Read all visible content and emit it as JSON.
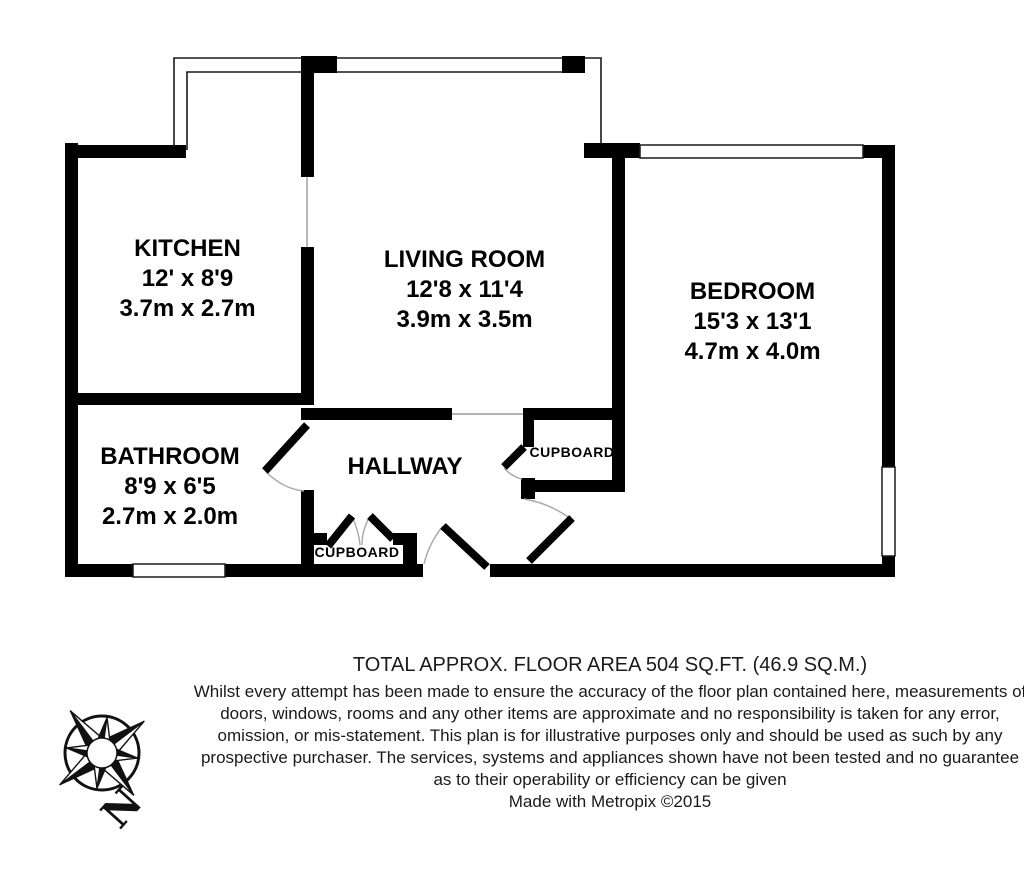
{
  "plan": {
    "rooms": {
      "kitchen": {
        "name": "KITCHEN",
        "imperial": "12' x 8'9",
        "metric": "3.7m x 2.7m"
      },
      "living_room": {
        "name": "LIVING ROOM",
        "imperial": "12'8 x 11'4",
        "metric": "3.9m x 3.5m"
      },
      "bedroom": {
        "name": "BEDROOM",
        "imperial": "15'3 x 13'1",
        "metric": "4.7m x 4.0m"
      },
      "bathroom": {
        "name": "BATHROOM",
        "imperial": "8'9 x 6'5",
        "metric": "2.7m x 2.0m"
      },
      "hallway": {
        "name": "HALLWAY"
      },
      "cupboard_hall": {
        "name": "CUPBOARD"
      },
      "cupboard_entry": {
        "name": "CUPBOARD"
      }
    },
    "colors": {
      "wall": "#000000",
      "background": "#ffffff",
      "door_arc": "#a8a8a8"
    }
  },
  "footer": {
    "area_line": "TOTAL APPROX. FLOOR AREA 504 SQ.FT. (46.9 SQ.M.)",
    "disclaimer": "Whilst every attempt has been made to ensure the accuracy of the floor plan contained here, measurements of doors, windows, rooms and any other items are approximate and no responsibility is taken for any error, omission, or mis-statement. This plan is for illustrative purposes only and should be used as such by any prospective purchaser. The services, systems and appliances shown have not been tested and no guarantee as to their operability or efficiency can be given",
    "credit": "Made with Metropix ©2015"
  },
  "compass": {
    "north_label": "N"
  }
}
